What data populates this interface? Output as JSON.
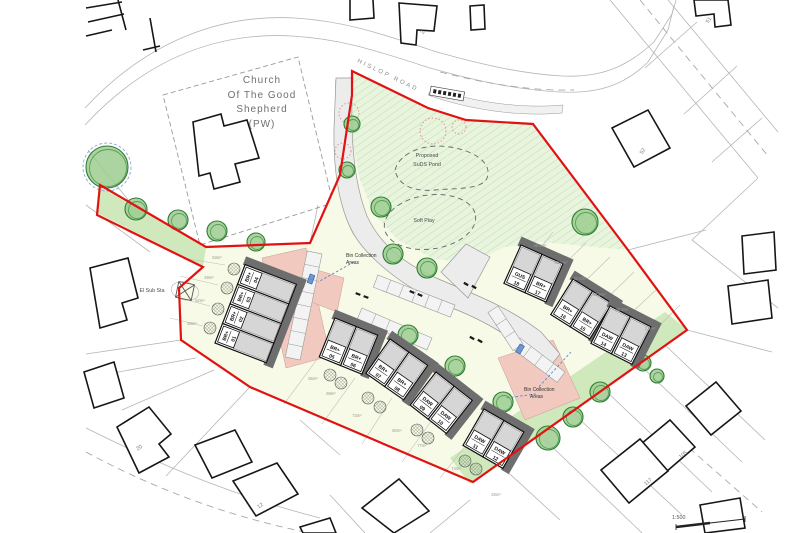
{
  "title": "Residential development site layout plan",
  "colors": {
    "boundary": "#e01212",
    "open_space_green": "#e9f4df",
    "verge_green": "#cfe8bc",
    "garden_yellow": "#f7fae6",
    "parking_court_pink": "#f2c9bf",
    "road_grey": "#ececec",
    "house_shadow": "#6e6e6e",
    "house_grey": "#d6d6d6",
    "tree_green": "#9ccc8f",
    "marker_blue": "#5588cc"
  },
  "labels": {
    "church_1": "Church",
    "church_2": "Of The Good",
    "church_3": "Shepherd",
    "church_4": "(PW)",
    "road": "HISLOP ROAD",
    "pond_1": "Proposed",
    "pond_2": "SuDS Pond",
    "soft_play": "Soft Play",
    "bin1_1": "Bin Collection",
    "bin1_2": "Areas",
    "bin2_1": "Bin Collection",
    "bin2_2": "Areas",
    "el_sub": "El Sub Sta",
    "scale": "1:500"
  },
  "context_numbers": [
    {
      "t": "2",
      "x": 424,
      "y": 33,
      "r": -58
    },
    {
      "t": "51",
      "x": 710,
      "y": 21,
      "r": -58
    },
    {
      "t": "52",
      "x": 644,
      "y": 152,
      "r": -58
    },
    {
      "t": "105",
      "x": 684,
      "y": 456,
      "r": -38
    },
    {
      "t": "117",
      "x": 649,
      "y": 483,
      "r": -38
    },
    {
      "t": "20",
      "x": 140,
      "y": 449,
      "r": -32
    },
    {
      "t": "12",
      "x": 261,
      "y": 507,
      "r": -32
    }
  ],
  "plots": {
    "blocks": [
      {
        "id": "terrace-01-04",
        "x": 215,
        "y": 343,
        "angle": -69,
        "uw": 21,
        "ud": 55,
        "labelSide": "start",
        "units": [
          {
            "t": "BR+",
            "n": "01"
          },
          {
            "t": "BR+",
            "n": "02"
          },
          {
            "t": "BR+",
            "n": "03"
          },
          {
            "t": "BR+",
            "n": "04"
          }
        ]
      },
      {
        "id": "pair-05-06",
        "x": 335,
        "y": 318,
        "angle": 22,
        "uw": 23,
        "ud": 42,
        "labelSide": "end",
        "units": [
          {
            "t": "BR+",
            "n": "05"
          },
          {
            "t": "BR+",
            "n": "06"
          }
        ]
      },
      {
        "id": "pair-07-08",
        "x": 390,
        "y": 339,
        "angle": 35,
        "uw": 23,
        "ud": 42,
        "labelSide": "end",
        "units": [
          {
            "t": "BR+",
            "n": "07"
          },
          {
            "t": "BR+",
            "n": "08"
          }
        ]
      },
      {
        "id": "pair-09-10",
        "x": 436,
        "y": 372,
        "angle": 38,
        "uw": 23,
        "ud": 42,
        "labelSide": "end",
        "units": [
          {
            "t": "DAW",
            "n": "09"
          },
          {
            "t": "DAW",
            "n": "10"
          }
        ]
      },
      {
        "id": "pair-11-12",
        "x": 484,
        "y": 409,
        "angle": 30,
        "uw": 23,
        "ud": 42,
        "labelSide": "end",
        "units": [
          {
            "t": "DAW",
            "n": "11"
          },
          {
            "t": "DAW",
            "n": "12"
          }
        ]
      },
      {
        "id": "pair-18-17",
        "x": 521,
        "y": 245,
        "angle": 24,
        "uw": 23,
        "ud": 42,
        "labelSide": "end",
        "units": [
          {
            "t": "GUS",
            "n": "18"
          },
          {
            "t": "BR+",
            "n": "17"
          }
        ]
      },
      {
        "id": "pair-16-15",
        "x": 573,
        "y": 279,
        "angle": 32,
        "uw": 23,
        "ud": 42,
        "labelSide": "end",
        "units": [
          {
            "t": "BR+",
            "n": "16"
          },
          {
            "t": "BR+",
            "n": "15"
          }
        ]
      },
      {
        "id": "pair-14-13",
        "x": 610,
        "y": 306,
        "angle": 27,
        "uw": 23,
        "ud": 42,
        "labelSide": "end",
        "units": [
          {
            "t": "DAW",
            "n": "14"
          },
          {
            "t": "DAW",
            "n": "13"
          }
        ]
      }
    ]
  },
  "trees": [
    {
      "x": 107,
      "y": 167,
      "r": 21,
      "big": true
    },
    {
      "x": 136,
      "y": 209,
      "r": 11
    },
    {
      "x": 178,
      "y": 220,
      "r": 10
    },
    {
      "x": 217,
      "y": 231,
      "r": 10
    },
    {
      "x": 256,
      "y": 242,
      "r": 9
    },
    {
      "x": 352,
      "y": 124,
      "r": 8
    },
    {
      "x": 347,
      "y": 170,
      "r": 8
    },
    {
      "x": 381,
      "y": 207,
      "r": 10
    },
    {
      "x": 393,
      "y": 254,
      "r": 10
    },
    {
      "x": 427,
      "y": 268,
      "r": 10
    },
    {
      "x": 585,
      "y": 222,
      "r": 13
    },
    {
      "x": 408,
      "y": 335,
      "r": 10
    },
    {
      "x": 455,
      "y": 366,
      "r": 10
    },
    {
      "x": 503,
      "y": 402,
      "r": 10
    },
    {
      "x": 643,
      "y": 363,
      "r": 8
    },
    {
      "x": 657,
      "y": 376,
      "r": 7
    },
    {
      "x": 600,
      "y": 392,
      "r": 10
    },
    {
      "x": 573,
      "y": 417,
      "r": 10
    },
    {
      "x": 548,
      "y": 438,
      "r": 12
    }
  ],
  "shrubs": [
    {
      "x": 234,
      "y": 269
    },
    {
      "x": 227,
      "y": 288
    },
    {
      "x": 218,
      "y": 309
    },
    {
      "x": 210,
      "y": 328
    },
    {
      "x": 330,
      "y": 375
    },
    {
      "x": 341,
      "y": 383
    },
    {
      "x": 368,
      "y": 398
    },
    {
      "x": 380,
      "y": 407
    },
    {
      "x": 417,
      "y": 430
    },
    {
      "x": 428,
      "y": 438
    },
    {
      "x": 465,
      "y": 461
    },
    {
      "x": 476,
      "y": 469
    },
    {
      "x": 540,
      "y": 263
    },
    {
      "x": 551,
      "y": 272
    },
    {
      "x": 580,
      "y": 292
    },
    {
      "x": 591,
      "y": 300
    },
    {
      "x": 623,
      "y": 320
    },
    {
      "x": 634,
      "y": 328
    }
  ],
  "area_labels": [
    {
      "t": "53m²",
      "x": 217,
      "y": 259
    },
    {
      "t": "49m²",
      "x": 209,
      "y": 279
    },
    {
      "t": "52m²",
      "x": 200,
      "y": 302
    },
    {
      "t": "58m²",
      "x": 192,
      "y": 325
    },
    {
      "t": "55m²",
      "x": 313,
      "y": 380
    },
    {
      "t": "69m²",
      "x": 331,
      "y": 395
    },
    {
      "t": "73m²",
      "x": 357,
      "y": 417
    },
    {
      "t": "80m²",
      "x": 397,
      "y": 432
    },
    {
      "t": "77m²",
      "x": 422,
      "y": 447
    },
    {
      "t": "74m²",
      "x": 456,
      "y": 470
    },
    {
      "t": "28m²",
      "x": 496,
      "y": 496
    },
    {
      "t": "95.9m²",
      "x": 540,
      "y": 247
    },
    {
      "t": "60.5m²",
      "x": 561,
      "y": 264
    },
    {
      "t": "62.5m²",
      "x": 580,
      "y": 280
    },
    {
      "t": "63.9m²",
      "x": 599,
      "y": 296
    },
    {
      "t": "48.9m²",
      "x": 622,
      "y": 311
    },
    {
      "t": "2.9m²",
      "x": 650,
      "y": 330
    }
  ],
  "parking_strips": [
    {
      "x1": 322,
      "y1": 254,
      "x2": 300,
      "y2": 360,
      "w": 15,
      "n": 8
    },
    {
      "x1": 378,
      "y1": 275,
      "x2": 455,
      "y2": 305,
      "w": 13,
      "n": 6
    },
    {
      "x1": 362,
      "y1": 308,
      "x2": 432,
      "y2": 338,
      "w": 13,
      "n": 5
    },
    {
      "x1": 520,
      "y1": 338,
      "x2": 565,
      "y2": 372,
      "w": 13,
      "n": 4
    },
    {
      "x1": 498,
      "y1": 306,
      "x2": 523,
      "y2": 344,
      "w": 12,
      "n": 3
    }
  ],
  "bin_markers": [
    {
      "x": 311,
      "y": 279,
      "r": 20
    },
    {
      "x": 520,
      "y": 349,
      "r": 30
    }
  ],
  "bin_leaders": [
    [
      354,
      262,
      318,
      282
    ],
    [
      536,
      390,
      571,
      352
    ],
    [
      536,
      394,
      506,
      398
    ]
  ],
  "tree_removal_circles": [
    {
      "x": 349,
      "y": 113,
      "r": 10
    },
    {
      "x": 433,
      "y": 131,
      "r": 13
    },
    {
      "x": 459,
      "y": 127,
      "r": 7
    },
    {
      "x": 343,
      "y": 151,
      "r": 8
    }
  ]
}
